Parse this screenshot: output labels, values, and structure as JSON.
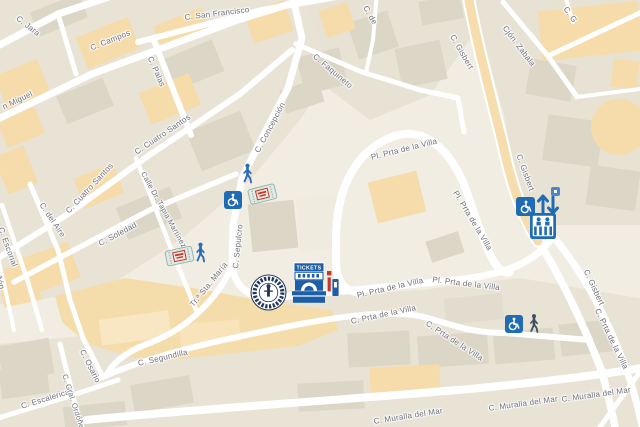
{
  "streets": [
    {
      "text": "C. Jara"
    },
    {
      "text": "C. Campos"
    },
    {
      "text": "C. San Francisco"
    },
    {
      "text": "C. Palas"
    },
    {
      "text": "n Miguel"
    },
    {
      "text": "C. Cuatro Santos"
    },
    {
      "text": "C. Cuatro Santos"
    },
    {
      "text": "Calle Dr. Tapia Martínez"
    },
    {
      "text": "C. Faquineto"
    },
    {
      "text": "C. Concepción"
    },
    {
      "text": "C. Sepulcro"
    },
    {
      "text": "Tr.ª Sta. María"
    },
    {
      "text": "C. Soledad"
    },
    {
      "text": "C. del Aire"
    },
    {
      "text": "C. Escorial"
    },
    {
      "text": "Cañón"
    },
    {
      "text": "C. Osario"
    },
    {
      "text": "C. Segundilla"
    },
    {
      "text": "C. Escalericas"
    },
    {
      "text": "C. Gral. Ordóñez"
    },
    {
      "text": "C. de"
    },
    {
      "text": "C. G"
    },
    {
      "text": "Cjón. Zabala"
    },
    {
      "text": "C. Gisbert"
    },
    {
      "text": "C. Gisbert"
    },
    {
      "text": "C. Gisbert"
    },
    {
      "text": "Pl. Prta de la Villa"
    },
    {
      "text": "Pl. Prta de la Villa"
    },
    {
      "text": "Pl. Prta de la Villa"
    },
    {
      "text": "Pl. Prta de la Villa"
    },
    {
      "text": "C. Prta de la Villa"
    },
    {
      "text": "C. Prta de la Villa"
    },
    {
      "text": "C. Prta de la Villa"
    },
    {
      "text": "C. Muralla del Mar"
    },
    {
      "text": "C. Muralla del Mar"
    },
    {
      "text": "C. Muralla del Mar"
    }
  ],
  "poi": {
    "tickets_booth_label": "TICKETS",
    "markers": [
      {
        "name": "walking-person-icon"
      },
      {
        "name": "wheelchair-icon"
      },
      {
        "name": "ticket-voucher-icon"
      },
      {
        "name": "walking-person-icon"
      },
      {
        "name": "ticket-voucher-icon"
      },
      {
        "name": "circular-seal-icon"
      },
      {
        "name": "ticket-booth-icon"
      },
      {
        "name": "wheelchair-icon"
      },
      {
        "name": "up-down-arrows-icon"
      },
      {
        "name": "elevator-icon"
      },
      {
        "name": "small-poi-square-icon"
      },
      {
        "name": "wheelchair-icon"
      },
      {
        "name": "dark-walking-person-icon"
      }
    ]
  },
  "colors": {
    "map_background": "#f1ede2",
    "building_gray": "#e8e3d5",
    "building_dark": "#dcd6c6",
    "building_orange": "#f6dcaa",
    "hillside_tan": "#f5ddab",
    "road_white": "#ffffff",
    "main_road_tan": "#f6ddae",
    "label_gray": "#6f6f7a",
    "icon_blue": "#1f6cb4",
    "ticket_red": "#c8372d",
    "seal_navy": "#22365e",
    "dark_pedestrian": "#3d4f63"
  }
}
